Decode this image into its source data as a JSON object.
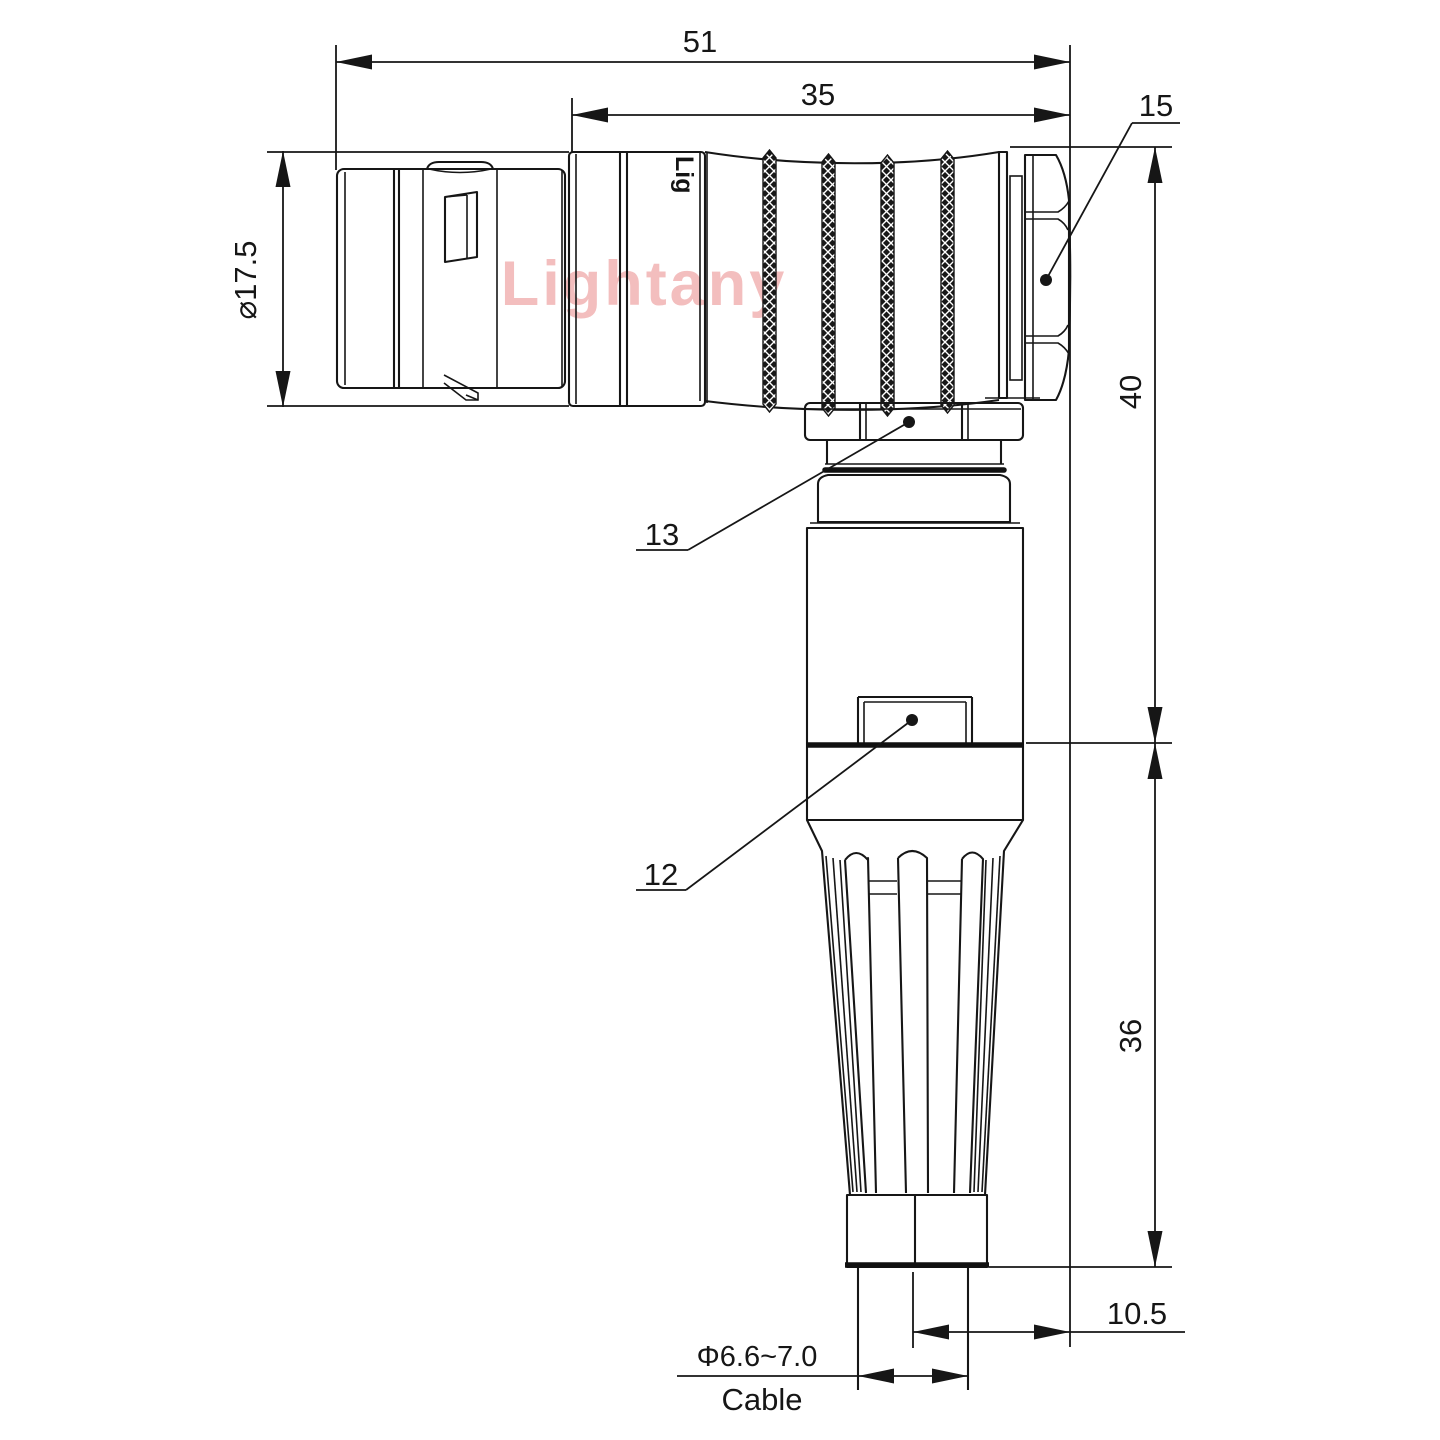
{
  "drawing": {
    "title_semantics": "right-angle connector technical drawing",
    "dimensions": {
      "overall_length": "51",
      "body_length": "35",
      "nut_part_label": "15",
      "shell_diameter": "⌀17.5",
      "elbow_height": "40",
      "boot_height": "36",
      "collar_part_label": "13",
      "latch_part_label": "12",
      "cable_offset": "10.5",
      "cable_diameter": "Φ6.6~7.0",
      "cable_label": "Cable"
    },
    "watermark": "Lightany",
    "body_marking": "Lig",
    "colors": {
      "line": "#161616",
      "background": "#ffffff",
      "watermark": "#f3bebe"
    }
  }
}
